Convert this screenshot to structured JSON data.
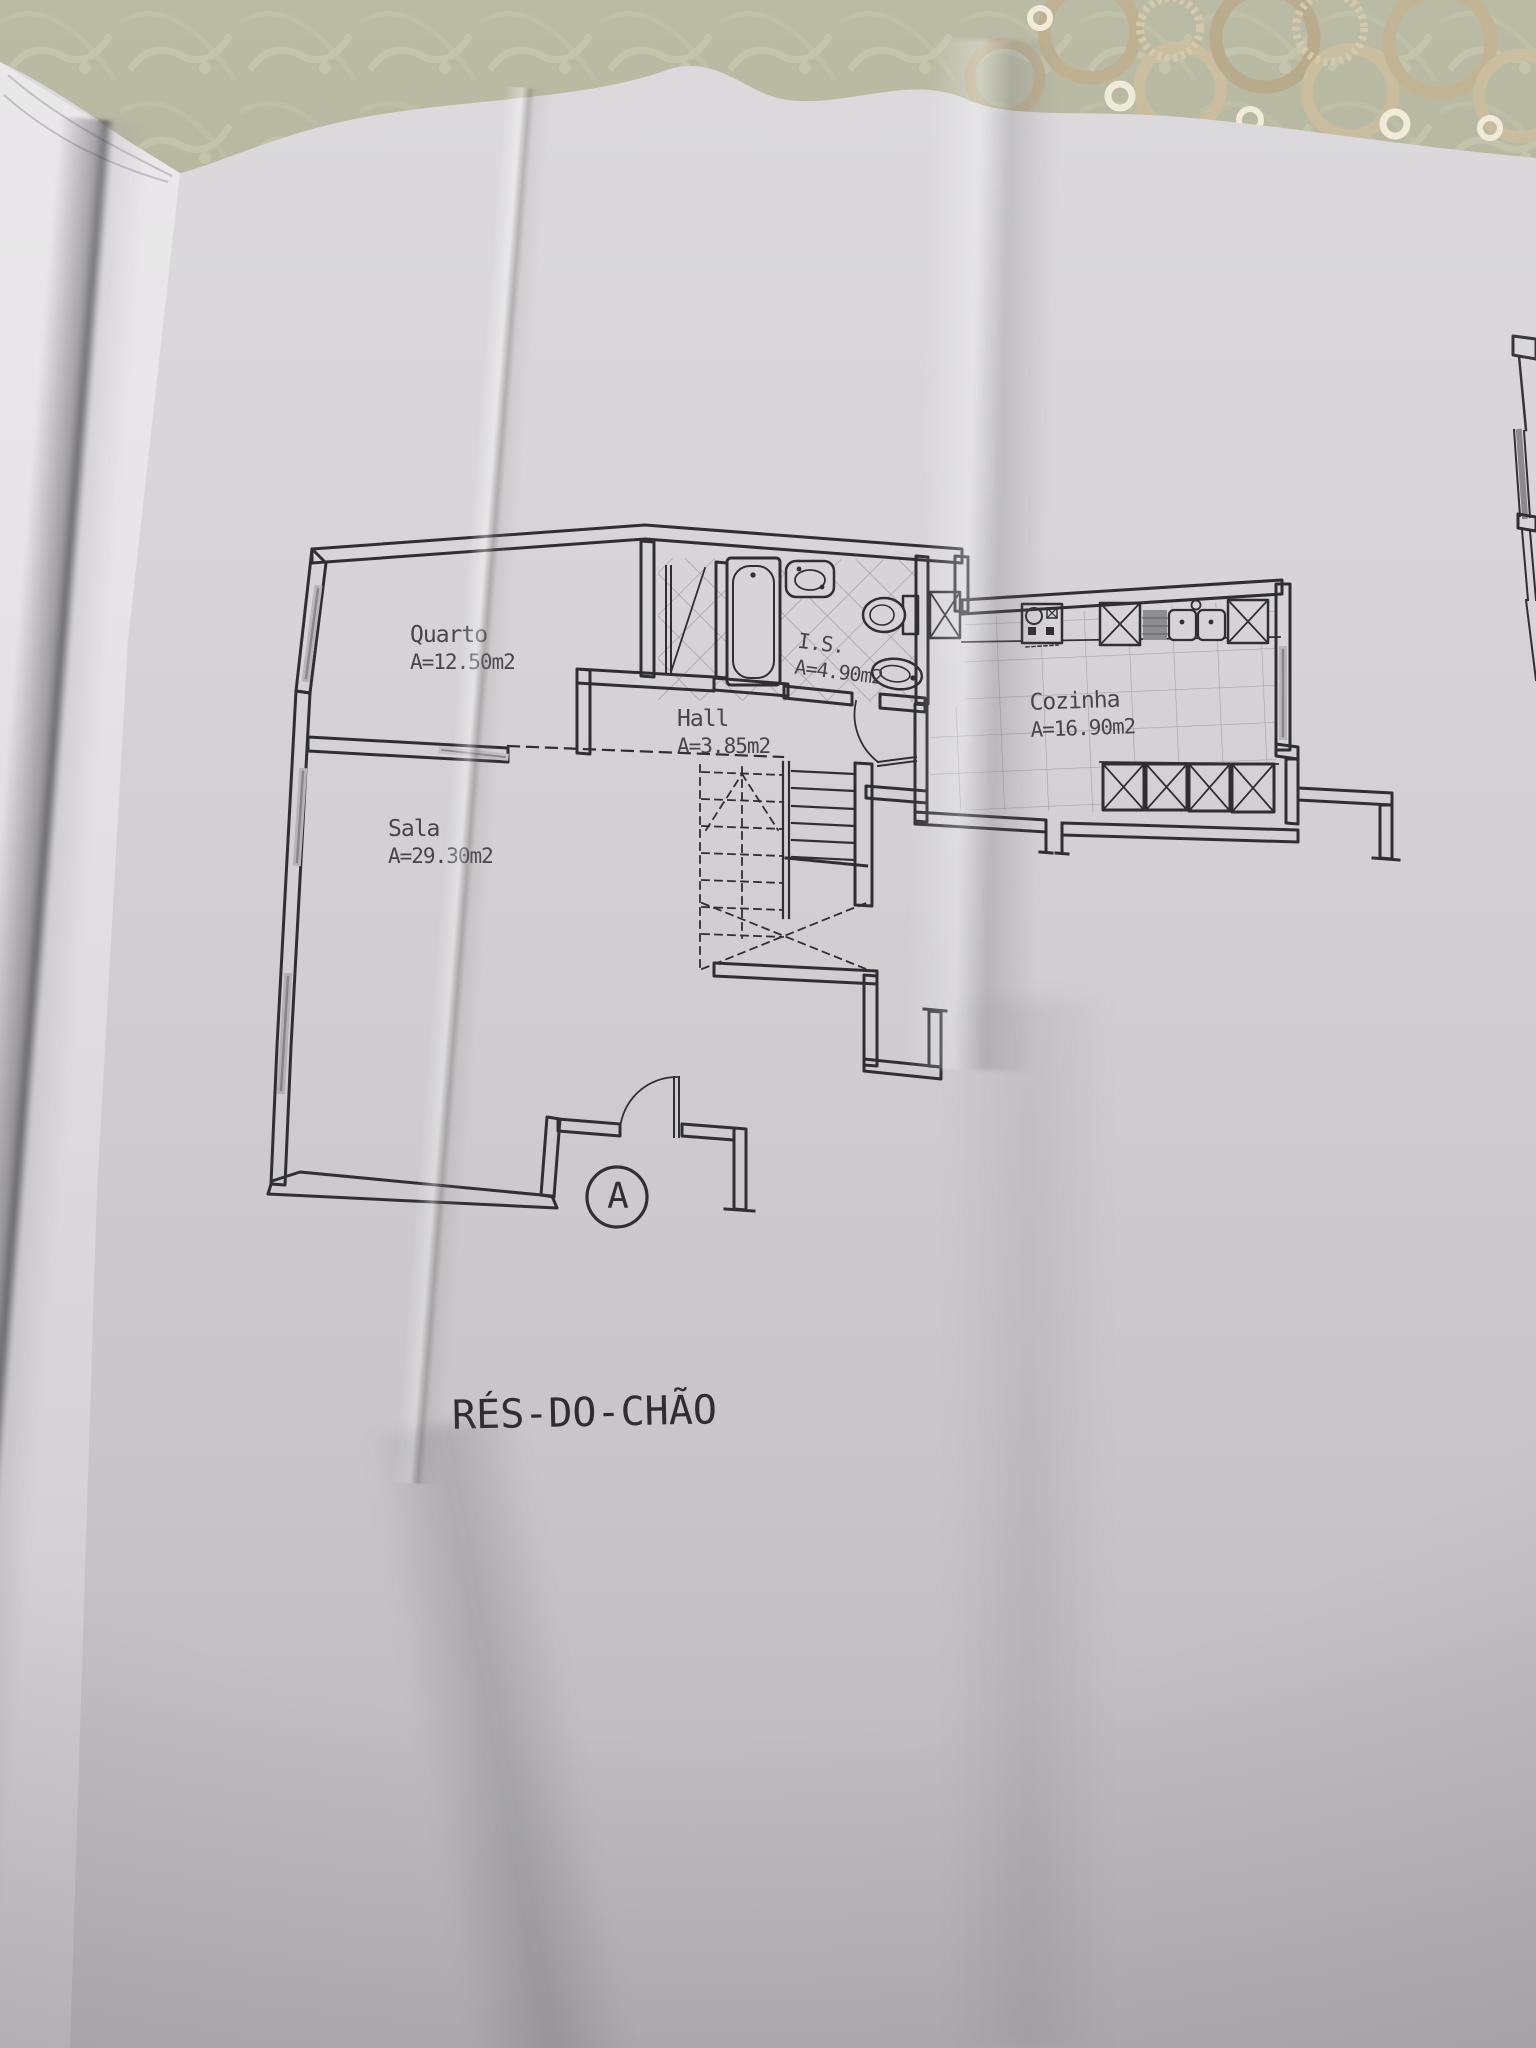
{
  "floor_plan": {
    "title": "RÉS-DO-CHÃO",
    "section_marker": "A",
    "rooms": [
      {
        "id": "quarto",
        "name": "Quarto",
        "area": "A=12.50m2"
      },
      {
        "id": "sala",
        "name": "Sala",
        "area": "A=29.30m2"
      },
      {
        "id": "hall",
        "name": "Hall",
        "area": "A=3.85m2"
      },
      {
        "id": "is",
        "name": "I.S.",
        "area": "A=4.90m2"
      },
      {
        "id": "cozinha",
        "name": "Cozinha",
        "area": "A=16.90m2"
      }
    ],
    "fixtures": [
      "bathtub",
      "washbasin",
      "toilet",
      "bidet",
      "stove",
      "kitchen-sink",
      "base-cabinets",
      "stairs",
      "entrance-door",
      "wardrobe-door"
    ],
    "colors": {
      "paper": "#d7d5d8",
      "ink": "#2f2e33",
      "tile_line": "#a8a6ac",
      "tablecloth": "#b1b298",
      "lace": "#c3b694"
    }
  }
}
